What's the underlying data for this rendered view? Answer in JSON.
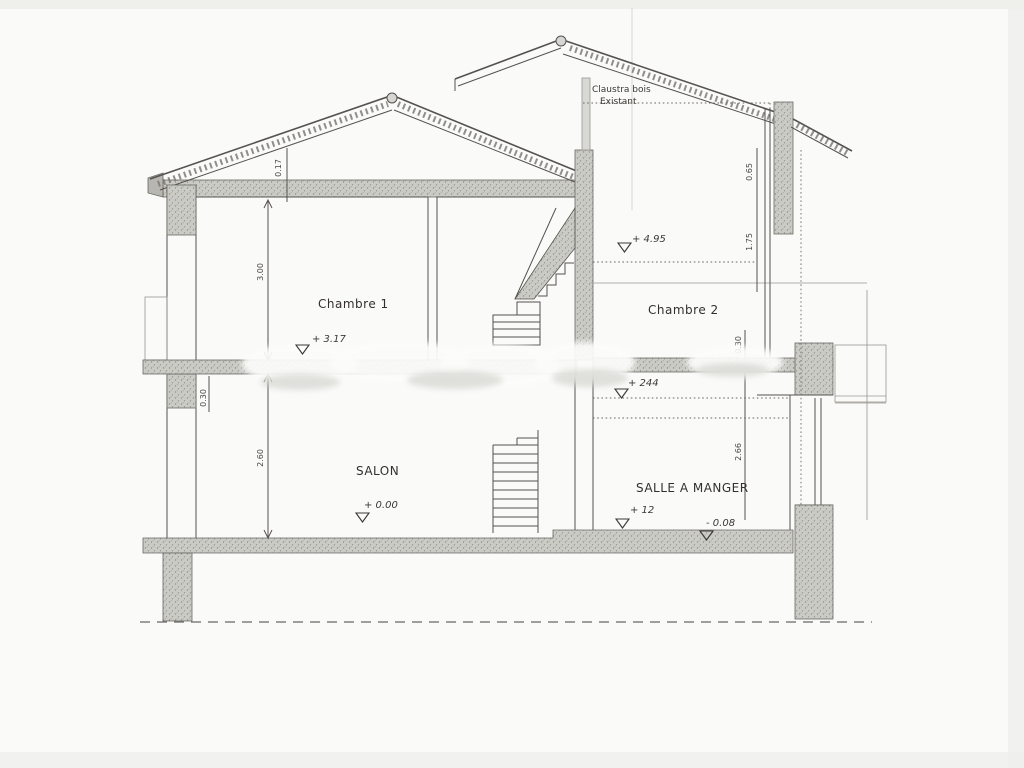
{
  "drawing": {
    "kind": "architectural-section-scan",
    "note": {
      "line1": "Claustra bois",
      "line2": "Existant"
    },
    "rooms": {
      "chambre1": "Chambre 1",
      "chambre2": "Chambre 2",
      "salon": "SALON",
      "salle_a_manger": "SALLE A MANGER"
    },
    "levels": {
      "floor1_left": "+ 3.17",
      "ceiling_right": "+ 4.95",
      "floor1_right": "+ 244",
      "ground_salon": "+ 0.00",
      "ground_sam_left": "+ 12",
      "ground_sam_right": "- 0.08"
    },
    "dimensions": {
      "roof_slab": "0.17",
      "chambre1_height": "3.00",
      "salon_height": "2.60",
      "slab_left": "0.30",
      "right_top": "0.65",
      "right_upper": "1.75",
      "right_slab": "0.30",
      "right_lower": "2.66"
    },
    "colors": {
      "ink": "#56534e",
      "hatch": "#cbcbc6",
      "paper": "#fafaf9"
    }
  }
}
